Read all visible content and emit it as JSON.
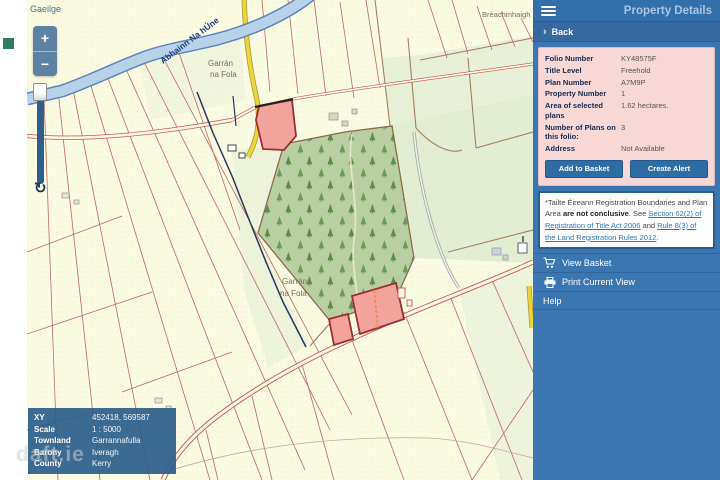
{
  "language_link": "Gaeilge",
  "map": {
    "zoom_in": "+",
    "zoom_out": "−",
    "refresh": "↻",
    "watermark": "daft.ie",
    "labels": {
      "river": "Abhainn Na hÚne",
      "townland_top_1": "Garrán",
      "townland_top_2": "na Fola",
      "townland_center_1": "Garrán",
      "townland_center_2": "na Fola",
      "neighbor_townland": "Bréachmhaigh"
    }
  },
  "info_box": {
    "rows": [
      {
        "label": "XY",
        "value": "452418, 569587"
      },
      {
        "label": "Scale",
        "value": "1 : 5000"
      },
      {
        "label": "Townland",
        "value": "Garrannafulla"
      },
      {
        "label": "Barony",
        "value": "Iveragh"
      },
      {
        "label": "County",
        "value": "Kerry"
      }
    ]
  },
  "panel": {
    "title": "Property Details",
    "back_chevron": "›",
    "back_label": "Back",
    "details": [
      {
        "label": "Folio Number",
        "value": "KY48575F"
      },
      {
        "label": "Title Level",
        "value": "Freehold"
      },
      {
        "label": "Plan Number",
        "value": "A7M9P"
      },
      {
        "label": "Property Number",
        "value": "1"
      },
      {
        "label": "Area of selected plans",
        "value": "1.62 hectares."
      },
      {
        "label": "Number of Plans on this folio:",
        "value": "3"
      },
      {
        "label": "Address",
        "value": "Not Available"
      }
    ],
    "buttons": {
      "add_to_basket": "Add to Basket",
      "create_alert": "Create Alert"
    },
    "disclaimer": {
      "prefix": "*Tailte Éireann Registration Boundaries and Plan Area ",
      "bold": "are not conclusive",
      "mid": ". See ",
      "link1": "Section 62(2) of Registration of Title Act 2006",
      "and": " and ",
      "link2": "Rule 8(3) of the Land Registration Rules 2012",
      "suffix": "."
    },
    "menu": [
      {
        "label": "View Basket",
        "icon": "cart"
      },
      {
        "label": "Print Current View",
        "icon": "printer"
      },
      {
        "label": "Help",
        "icon": ""
      }
    ]
  },
  "colors": {
    "panel_bg": "#3b76b1",
    "button_bg": "#2e6da4",
    "details_card_bg": "#f8d8d7",
    "selected_plan_fill": "#f2a49c",
    "selected_plan_border": "#9c2f2f",
    "forest_fill": "#b9cfa3",
    "river_fill": "#b9d2ea",
    "road_casing": "#c2574d",
    "yellow_road": "#e9d63e",
    "link": "#2e75b6"
  }
}
